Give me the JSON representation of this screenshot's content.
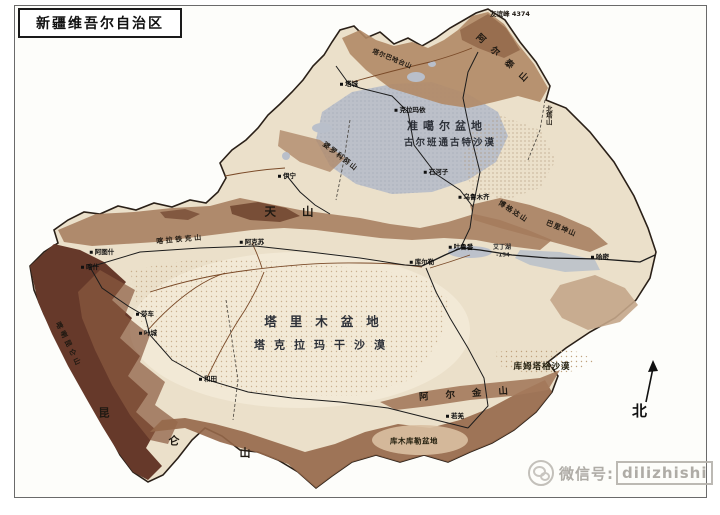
{
  "title_box": {
    "text": "新疆维吾尔自治区"
  },
  "compass": {
    "label": "北"
  },
  "watermark": {
    "prefix": "微信号:",
    "account": "dilizhishi"
  },
  "colors": {
    "map_base": "#ebe0ca",
    "basin_light": "#f2e9d6",
    "junggar_gray": "#b7bdc9",
    "altai_brown": "#b18a66",
    "tianshan_brown": "#a47a5c",
    "dark_brown": "#66392a",
    "tail_brown": "#96684a",
    "lake_gray": "#b9bfca",
    "river_brown": "#7a4a28",
    "road_black": "#1c1c1c",
    "border_black": "#2a2018",
    "frame_gray": "#6a6a6a",
    "label_dark": "#211c15",
    "watermark_gray": "#a7a49e"
  },
  "map": {
    "labels": [
      {
        "name": "label-junggar-basin",
        "text": "准噶尔盆地",
        "x": 447,
        "y": 126,
        "cls": "geo-lg",
        "fs": 11,
        "ls": 5
      },
      {
        "name": "label-gurbantunggut-desert",
        "text": "古尔班通古特沙漠",
        "x": 450,
        "y": 143,
        "cls": "geo-lg",
        "fs": 9.5,
        "ls": 2
      },
      {
        "name": "label-tarim-basin",
        "text": "塔里木盆地",
        "x": 328,
        "y": 322,
        "cls": "geo-lg",
        "fs": 12.5,
        "ls": 13
      },
      {
        "name": "label-taklamakan-desert",
        "text": "塔克拉玛干沙漠",
        "x": 324,
        "y": 345,
        "cls": "geo-lg",
        "fs": 11,
        "ls": 9
      },
      {
        "name": "label-kumtag-desert",
        "text": "库姆塔格沙漠",
        "x": 542,
        "y": 367,
        "cls": "geo-md",
        "fs": 8.5,
        "ls": 1
      },
      {
        "name": "label-kumkol-basin",
        "text": "库木库勒盆地",
        "x": 414,
        "y": 441,
        "cls": "geo-md",
        "fs": 7.5,
        "ls": 0.5
      },
      {
        "name": "label-tianshan",
        "text": "天山",
        "x": 302,
        "y": 212,
        "cls": "mount-big",
        "fs": 11.5,
        "ls": 26
      },
      {
        "name": "label-kunlun-char-1",
        "text": "昆",
        "x": 104,
        "y": 413,
        "cls": "mount-big",
        "fs": 11
      },
      {
        "name": "label-kunlun-char-2",
        "text": "仑",
        "x": 174,
        "y": 441,
        "cls": "mount-big",
        "fs": 11
      },
      {
        "name": "label-kunlun-char-3",
        "text": "山",
        "x": 245,
        "y": 453,
        "cls": "mount-big",
        "fs": 11
      },
      {
        "name": "label-altun-mountains",
        "text": "阿尔金山",
        "x": 472,
        "y": 394,
        "cls": "mount-big",
        "fs": 9.5,
        "ls": 17,
        "rot": -4
      },
      {
        "name": "label-altai-mountains",
        "text": "阿尔泰山",
        "x": 505,
        "y": 62,
        "cls": "mount-big",
        "fs": 9,
        "ls": 10,
        "rot": 42
      },
      {
        "name": "label-karakoram",
        "text": "喀喇昆仑山",
        "x": 68,
        "y": 345,
        "cls": "mount",
        "fs": 7,
        "ls": 3,
        "rot": 64
      },
      {
        "name": "label-kalatieke-mountain",
        "text": "喀拉铁克山",
        "x": 180,
        "y": 240,
        "cls": "mount",
        "fs": 7,
        "ls": 2.5,
        "rot": -5
      },
      {
        "name": "label-bogda-mountain",
        "text": "博格达山",
        "x": 513,
        "y": 212,
        "cls": "mount",
        "fs": 7,
        "ls": 1.5,
        "rot": 33
      },
      {
        "name": "label-barkol-mountain",
        "text": "巴里坤山",
        "x": 561,
        "y": 229,
        "cls": "mount",
        "fs": 7,
        "ls": 1,
        "rot": 22
      },
      {
        "name": "label-borohoro-mountain",
        "text": "婆罗科努山",
        "x": 340,
        "y": 157,
        "cls": "mount",
        "fs": 7,
        "ls": 1.5,
        "rot": 38
      },
      {
        "name": "label-tarbagatai-mountain",
        "text": "塔尔巴哈台山",
        "x": 392,
        "y": 59,
        "cls": "mount",
        "fs": 6.5,
        "ls": 0.5,
        "rot": 22
      },
      {
        "name": "label-beita-mountain",
        "text": "北塔山",
        "x": 548,
        "y": 115,
        "cls": "mount",
        "fs": 6.5,
        "vertical": true
      },
      {
        "name": "label-friendship-peak",
        "text": "友谊峰 4374",
        "x": 510,
        "y": 14,
        "cls": "peak",
        "fs": 6.5
      },
      {
        "name": "label-city-urumqi",
        "text": "乌鲁木齐",
        "x": 474,
        "y": 197,
        "cls": "city",
        "fs": 6.5
      },
      {
        "name": "label-city-karamay",
        "text": "克拉玛依",
        "x": 410,
        "y": 110,
        "cls": "city",
        "fs": 6.5
      },
      {
        "name": "label-city-shihezi",
        "text": "石河子",
        "x": 436,
        "y": 172,
        "cls": "city",
        "fs": 6.5
      },
      {
        "name": "label-city-turpan",
        "text": "吐鲁番",
        "x": 461,
        "y": 247,
        "cls": "city",
        "fs": 6.5
      },
      {
        "name": "label-city-hami",
        "text": "哈密",
        "x": 600,
        "y": 257,
        "cls": "city",
        "fs": 6.5
      },
      {
        "name": "label-city-korla",
        "text": "库尔勒",
        "x": 422,
        "y": 262,
        "cls": "city",
        "fs": 6.5
      },
      {
        "name": "label-city-aksu",
        "text": "阿克苏",
        "x": 252,
        "y": 242,
        "cls": "city",
        "fs": 6.5
      },
      {
        "name": "label-city-atush",
        "text": "阿图什",
        "x": 102,
        "y": 252,
        "cls": "city",
        "fs": 6.5
      },
      {
        "name": "label-city-kashgar",
        "text": "喀什",
        "x": 90,
        "y": 267,
        "cls": "city",
        "fs": 6.5
      },
      {
        "name": "label-city-shache",
        "text": "莎车",
        "x": 145,
        "y": 314,
        "cls": "city",
        "fs": 6.5
      },
      {
        "name": "label-city-yecheng",
        "text": "叶城",
        "x": 148,
        "y": 333,
        "cls": "city",
        "fs": 6.5
      },
      {
        "name": "label-city-hotan",
        "text": "和田",
        "x": 208,
        "y": 379,
        "cls": "city",
        "fs": 6.5
      },
      {
        "name": "label-city-yining",
        "text": "伊宁",
        "x": 287,
        "y": 176,
        "cls": "city",
        "fs": 6.5
      },
      {
        "name": "label-city-tacheng",
        "text": "塔城",
        "x": 349,
        "y": 84,
        "cls": "city",
        "fs": 6.5
      },
      {
        "name": "label-city-ruoqiang",
        "text": "若羌",
        "x": 455,
        "y": 416,
        "cls": "city",
        "fs": 6.5
      },
      {
        "name": "label-aiding-lake",
        "text": "艾丁湖",
        "x": 502,
        "y": 248,
        "cls": "lake-label",
        "fs": 6
      },
      {
        "name": "label-aiding-elevation",
        "text": "-154",
        "x": 503,
        "y": 256,
        "cls": "lake-label",
        "fs": 5.5
      }
    ]
  }
}
